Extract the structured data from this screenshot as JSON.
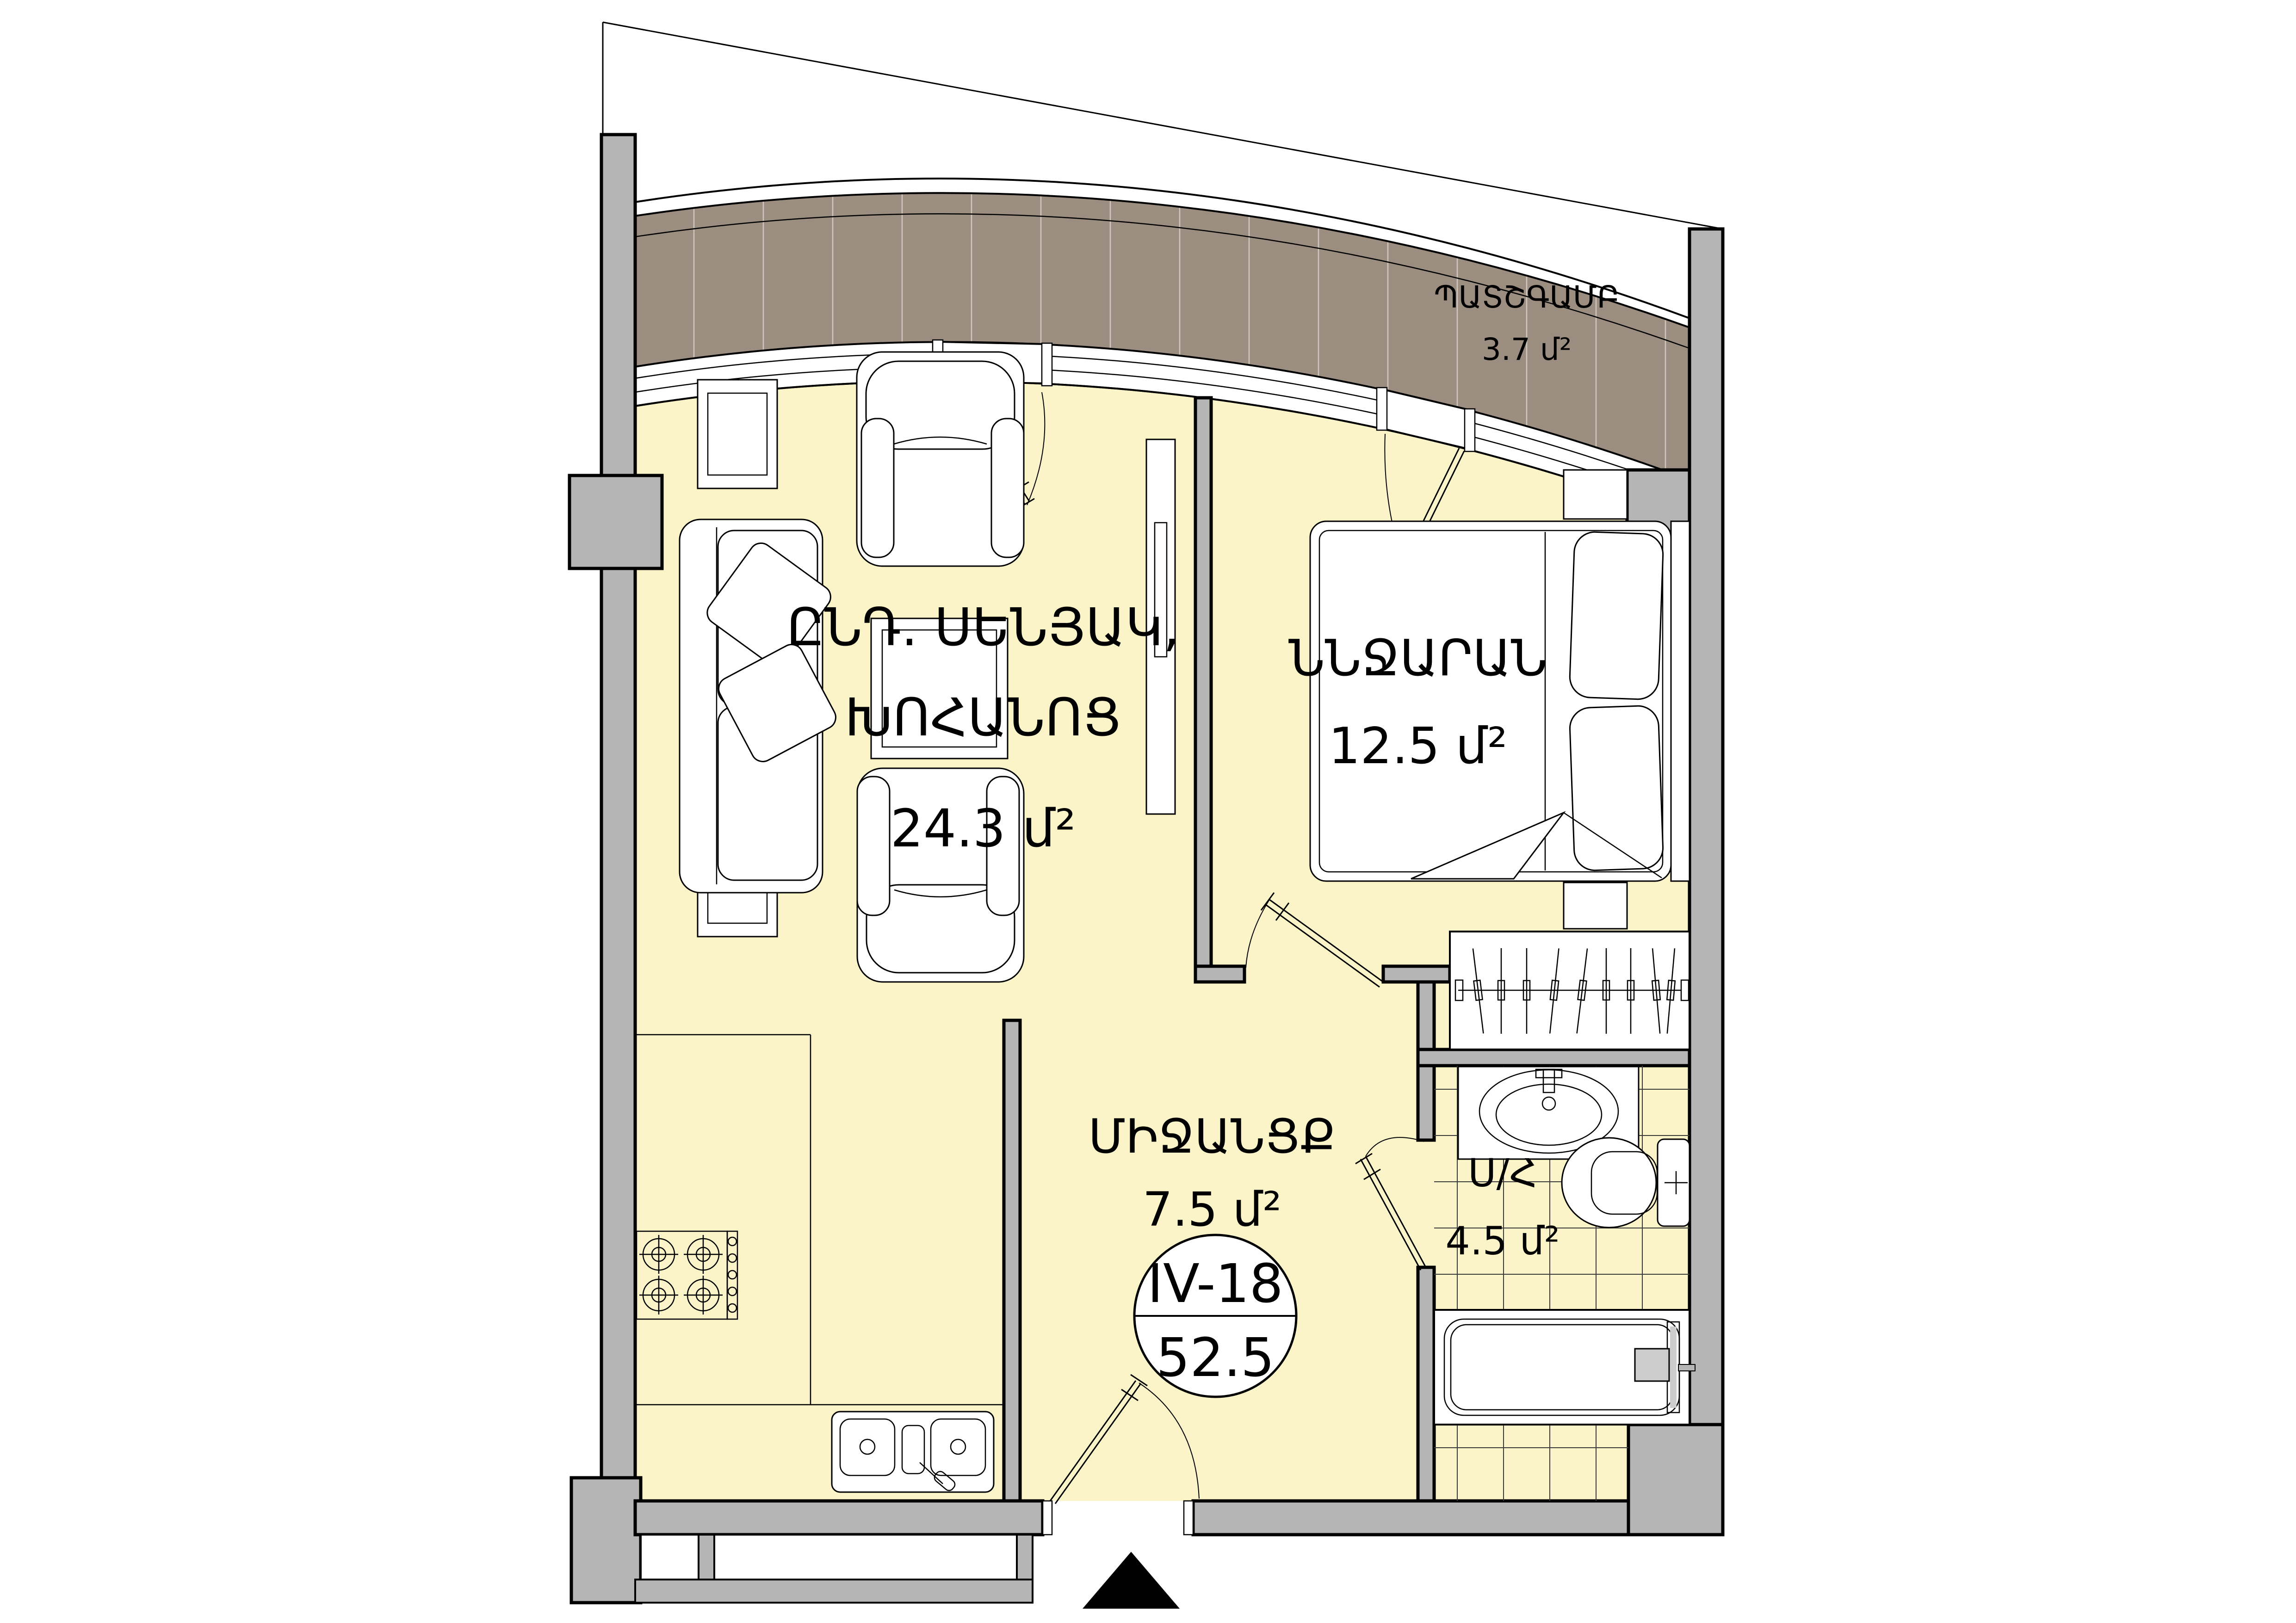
{
  "floorplan": {
    "unit": {
      "code": "IV-18",
      "total_area": "52.5"
    },
    "rooms": [
      {
        "id": "living-kitchen",
        "label_line1": "ԸՆԴ. ՍԵՆՅԱԿ,",
        "label_line2": "ԽՈՀԱՆՈՑ",
        "area_label": "24.3 մ²"
      },
      {
        "id": "bedroom",
        "label": "ՆՆՋԱՐԱՆ",
        "area_label": "12.5 մ²"
      },
      {
        "id": "hallway",
        "label": "ՄԻՋԱՆՑՔ",
        "area_label": "7.5 մ²"
      },
      {
        "id": "bathroom",
        "label": "Ս/Հ",
        "area_label": "4.5 մ²"
      },
      {
        "id": "balcony",
        "label": "ՊԱՏՇԳԱՄԲ",
        "area_label": "3.7 մ²"
      }
    ],
    "colors": {
      "floor": "#FBF4C8",
      "wall_fill": "#B5B5B5",
      "balcony_deck": "#9C8D81",
      "outline": "#000000",
      "tile_line": "#3A3A3A"
    }
  }
}
